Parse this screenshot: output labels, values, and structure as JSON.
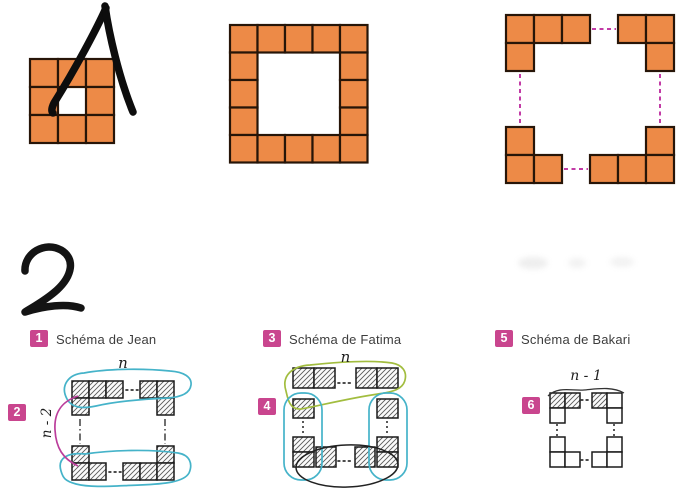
{
  "handwritten_numbers": {
    "first": "1",
    "second": "2"
  },
  "colors": {
    "orange": "#ed8a47",
    "orange_border": "#271508",
    "magenta": "#c23ba6",
    "badge_pink": "#c9458e",
    "cyan_outline": "#45b3c9",
    "green_outline": "#a2bd3f",
    "black_outline": "#222222"
  },
  "sequence": {
    "figures": [
      {
        "id": "pattern-1",
        "origin": [
          30,
          59
        ],
        "cell": 28,
        "cells": [
          [
            0,
            0
          ],
          [
            1,
            0
          ],
          [
            2,
            0
          ],
          [
            0,
            1
          ],
          [
            2,
            1
          ],
          [
            0,
            2
          ],
          [
            1,
            2
          ],
          [
            2,
            2
          ]
        ]
      },
      {
        "id": "pattern-2",
        "origin": [
          230,
          25
        ],
        "cell": 27.5,
        "cells": [
          [
            0,
            0
          ],
          [
            1,
            0
          ],
          [
            2,
            0
          ],
          [
            3,
            0
          ],
          [
            4,
            0
          ],
          [
            0,
            1
          ],
          [
            4,
            1
          ],
          [
            0,
            2
          ],
          [
            4,
            2
          ],
          [
            0,
            3
          ],
          [
            4,
            3
          ],
          [
            0,
            4
          ],
          [
            1,
            4
          ],
          [
            2,
            4
          ],
          [
            3,
            4
          ],
          [
            4,
            4
          ]
        ]
      },
      {
        "id": "pattern-3",
        "origin": [
          506,
          15
        ],
        "cell": 28,
        "cells": [
          [
            0,
            0
          ],
          [
            1,
            0
          ],
          [
            2,
            0
          ],
          [
            0,
            1
          ],
          [
            4,
            0
          ],
          [
            5,
            0
          ],
          [
            5,
            1
          ],
          [
            0,
            4
          ],
          [
            0,
            5
          ],
          [
            1,
            5
          ],
          [
            5,
            4
          ],
          [
            3,
            5
          ],
          [
            4,
            5
          ],
          [
            5,
            5
          ]
        ],
        "links": [
          [
            592,
            29,
            616,
            29
          ],
          [
            520,
            74,
            520,
            124
          ],
          [
            660,
            74,
            660,
            124
          ],
          [
            564,
            169,
            588,
            169
          ]
        ]
      }
    ]
  },
  "schemas": [
    {
      "badge": "1",
      "title": "Schéma de Jean",
      "sub_badge": "2",
      "top_label": "n",
      "side_label": "n - 2",
      "squares": [
        [
          72,
          381,
          17,
          17,
          1
        ],
        [
          89,
          381,
          17,
          17,
          1
        ],
        [
          106,
          381,
          17,
          17,
          1
        ],
        [
          140,
          381,
          17,
          17,
          1
        ],
        [
          157,
          381,
          17,
          17,
          1
        ],
        [
          72,
          398,
          17,
          17,
          1
        ],
        [
          157,
          398,
          17,
          17,
          1
        ],
        [
          72,
          446,
          17,
          17,
          1
        ],
        [
          157,
          446,
          17,
          17,
          1
        ],
        [
          72,
          463,
          17,
          17,
          1
        ],
        [
          89,
          463,
          17,
          17,
          1
        ],
        [
          123,
          463,
          17,
          17,
          1
        ],
        [
          140,
          463,
          17,
          17,
          1
        ],
        [
          157,
          463,
          17,
          17,
          1
        ]
      ],
      "dotlines": [
        [
          126,
          390,
          138,
          390
        ],
        [
          109,
          472,
          121,
          472
        ]
      ],
      "dashdots": [
        [
          80,
          419,
          80,
          444
        ],
        [
          165,
          419,
          165,
          444
        ]
      ],
      "dotted": []
    },
    {
      "badge": "3",
      "title": "Schéma de Fatima",
      "sub_badge": "4",
      "top_label": "n",
      "squares": [
        [
          293,
          368,
          21,
          20,
          1
        ],
        [
          314,
          368,
          21,
          20,
          1
        ],
        [
          356,
          368,
          21,
          20,
          1
        ],
        [
          377,
          368,
          21,
          20,
          1
        ],
        [
          293,
          399,
          21,
          19,
          1
        ],
        [
          377,
          399,
          21,
          19,
          1
        ],
        [
          293,
          437,
          21,
          15,
          1
        ],
        [
          293,
          452,
          21,
          15,
          1
        ],
        [
          377,
          437,
          21,
          15,
          1
        ],
        [
          377,
          452,
          21,
          15,
          1
        ],
        [
          316,
          447,
          20,
          20,
          1
        ],
        [
          355,
          447,
          20,
          20,
          1
        ]
      ],
      "dotlines": [
        [
          338,
          383,
          353,
          383
        ],
        [
          338,
          461,
          353,
          461
        ]
      ],
      "dashdots": [],
      "dotted": [
        [
          303,
          421,
          303,
          435
        ],
        [
          387,
          421,
          387,
          435
        ]
      ]
    },
    {
      "badge": "5",
      "title": "Schéma de Bakari",
      "sub_badge": "6",
      "top_label": "n - 1",
      "squares": [
        [
          550,
          393,
          15,
          15,
          1
        ],
        [
          565,
          393,
          15,
          15,
          1
        ],
        [
          592,
          393,
          15,
          15,
          1
        ],
        [
          607,
          393,
          15,
          15,
          0
        ],
        [
          550,
          408,
          15,
          15,
          0
        ],
        [
          607,
          408,
          15,
          15,
          0
        ],
        [
          550,
          437,
          15,
          15,
          0
        ],
        [
          550,
          452,
          15,
          15,
          0
        ],
        [
          565,
          452,
          15,
          15,
          0
        ],
        [
          607,
          437,
          15,
          15,
          0
        ],
        [
          592,
          452,
          15,
          15,
          0
        ],
        [
          607,
          452,
          15,
          15,
          0
        ]
      ],
      "dotlines": [
        [
          581,
          400,
          590,
          400
        ],
        [
          581,
          460,
          590,
          460
        ]
      ],
      "dashdots": [],
      "dotted": [
        [
          557,
          424,
          557,
          436
        ],
        [
          614,
          424,
          614,
          436
        ]
      ]
    }
  ]
}
